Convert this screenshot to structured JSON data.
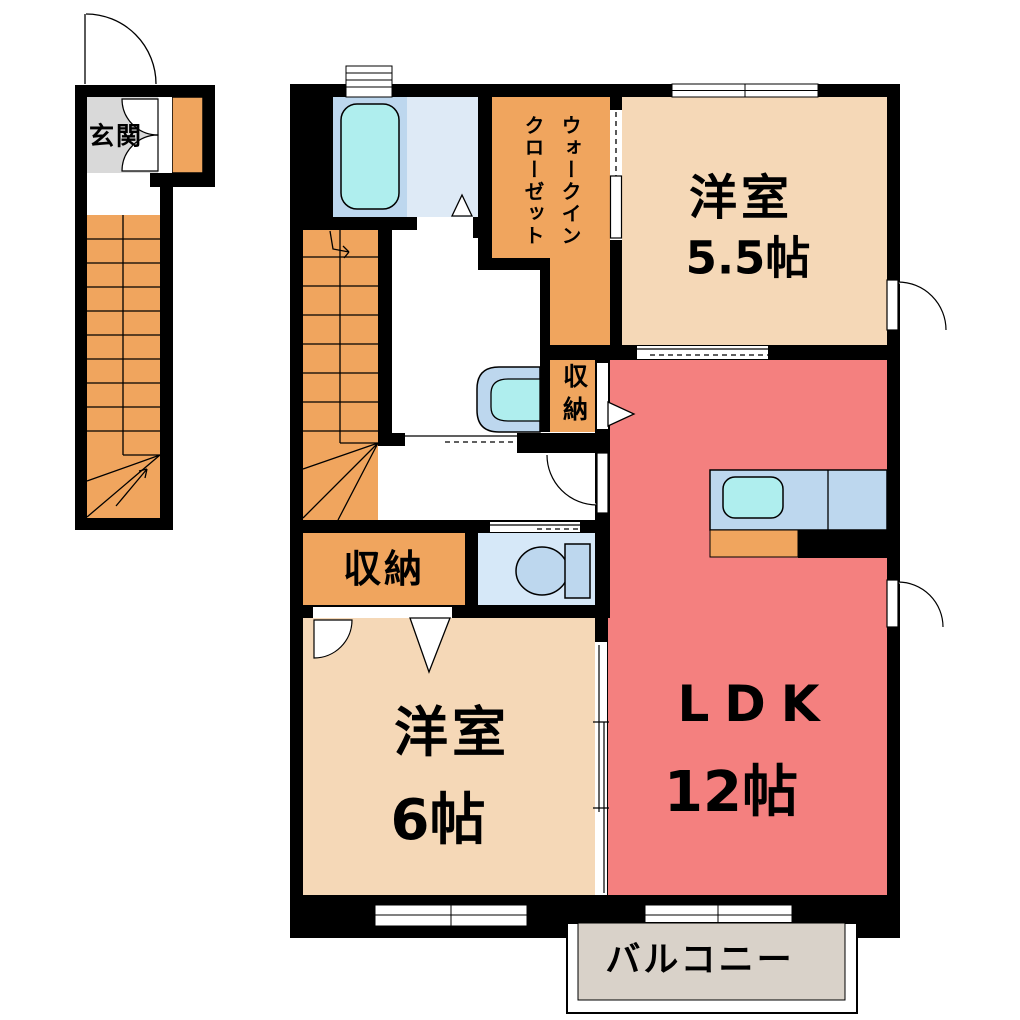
{
  "rooms": {
    "genkan": {
      "label": "玄関"
    },
    "walk_in_closet": {
      "label": "ウォークイン\nクローゼット"
    },
    "western_room_55": {
      "name": "洋室",
      "size": "5.5帖"
    },
    "ldk": {
      "name": "LDK",
      "size": "12帖"
    },
    "western_room_6": {
      "name": "洋室",
      "size": "6帖"
    },
    "storage_upper": {
      "label": "収納"
    },
    "storage_lower": {
      "label": "収納"
    },
    "balcony": {
      "label": "バルコニー"
    }
  },
  "colors": {
    "wall": "#000000",
    "room_peach": "#F5D8B7",
    "ldk_pink": "#F4807F",
    "stairs_orange": "#F0A55E",
    "genkan_gray": "#D9D9D9",
    "balcony_gray": "#D9D2C9",
    "fixture_blue": "#BDD7EE",
    "water_cyan": "#AFEEEE",
    "washroom_blue": "#DEEAF6",
    "toilet_blue": "#D6E8F8"
  }
}
